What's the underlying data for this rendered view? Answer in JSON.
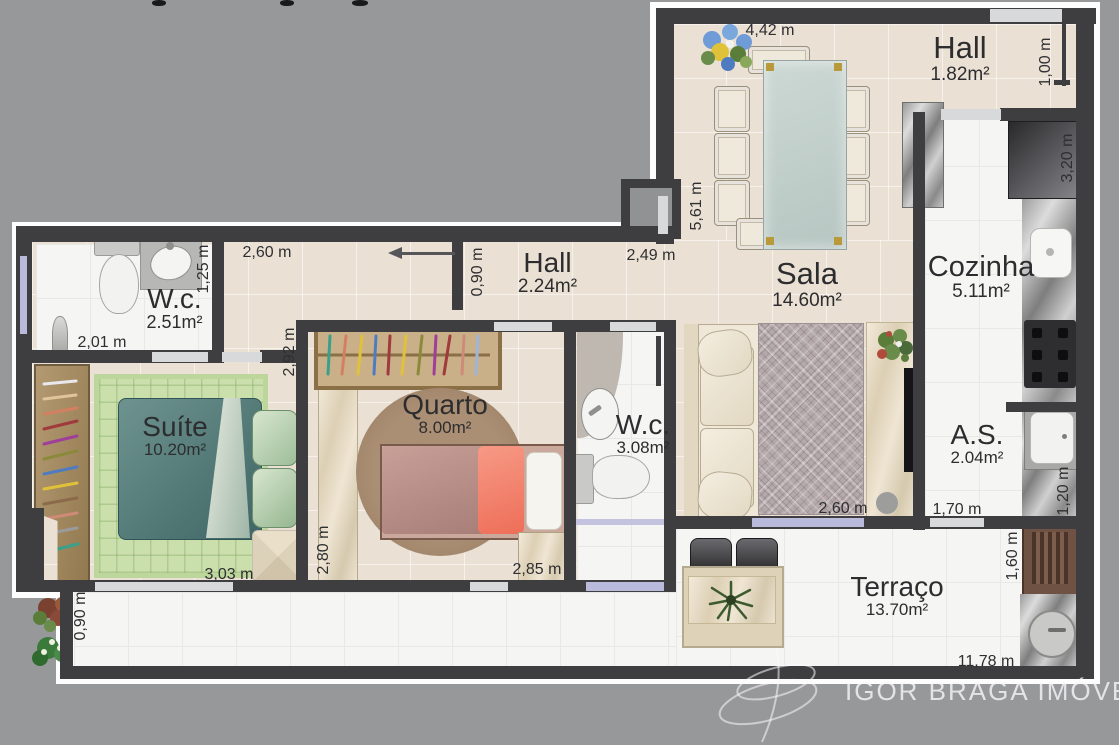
{
  "palette": {
    "background": "#97989a",
    "wall": "#3e3e40",
    "floor_beige": "#eae0d4",
    "floor_white": "#f5f5f3",
    "door_slab": "#d7d9db",
    "window_glass": "#b9badc",
    "label_text": "#2d2d2f",
    "watermark_text": "#f8f8fa"
  },
  "rooms": [
    {
      "id": "hall-entry",
      "name": "Hall",
      "area": "1.82m²"
    },
    {
      "id": "hall",
      "name": "Hall",
      "area": "2.24m²"
    },
    {
      "id": "sala",
      "name": "Sala",
      "area": "14.60m²"
    },
    {
      "id": "cozinha",
      "name": "Cozinha",
      "area": "5.11m²"
    },
    {
      "id": "wc-suite",
      "name": "W.c.",
      "area": "2.51m²"
    },
    {
      "id": "suite",
      "name": "Suíte",
      "area": "10.20m²"
    },
    {
      "id": "quarto",
      "name": "Quarto",
      "area": "8.00m²"
    },
    {
      "id": "wc-social",
      "name": "W.c.",
      "area": "3.08m²"
    },
    {
      "id": "area-servico",
      "name": "A.S.",
      "area": "2.04m²"
    },
    {
      "id": "terraco",
      "name": "Terraço",
      "area": "13.70m²"
    }
  ],
  "dimensions": [
    {
      "text": "4,42 m"
    },
    {
      "text": "1,00 m"
    },
    {
      "text": "5,61 m"
    },
    {
      "text": "3,20 m"
    },
    {
      "text": "2,60 m"
    },
    {
      "text": "0,90 m"
    },
    {
      "text": "2,49 m"
    },
    {
      "text": "1,25 m"
    },
    {
      "text": "2,01 m"
    },
    {
      "text": "2,92 m"
    },
    {
      "text": "2,80 m"
    },
    {
      "text": "3,03 m"
    },
    {
      "text": "2,85 m"
    },
    {
      "text": "2,60 m"
    },
    {
      "text": "1,70 m"
    },
    {
      "text": "1,20 m"
    },
    {
      "text": "1,60 m"
    },
    {
      "text": "0,90 m"
    },
    {
      "text": "11,78 m"
    }
  ],
  "watermark": {
    "brand": "IGOR BRAGA IMÓVEIS"
  }
}
